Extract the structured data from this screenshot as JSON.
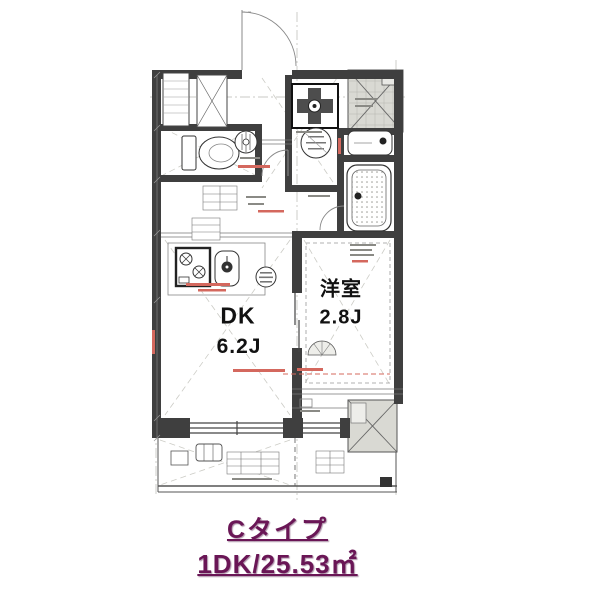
{
  "floorplan": {
    "rooms": [
      {
        "id": "dk",
        "name": "DK",
        "size": "6.2J"
      },
      {
        "id": "western_room",
        "name": "洋室",
        "size": "2.8J"
      }
    ],
    "caption": {
      "unit_type": "Cタイプ",
      "layout_area": "1DK/25.53㎡"
    },
    "symbols": [
      "entrance-door",
      "toilet",
      "ventilation-fan",
      "washing-machine-pan",
      "wash-basin",
      "bathtub",
      "stove",
      "kitchen-sink",
      "pipe-space",
      "elevator-hall",
      "balcony",
      "air-conditioner-unit"
    ],
    "colors": {
      "caption_text": "#6a1656",
      "wall": "#3f3f3f",
      "hatch_fill": "#d9d9d3",
      "dimension_red": "#d4685e"
    }
  }
}
